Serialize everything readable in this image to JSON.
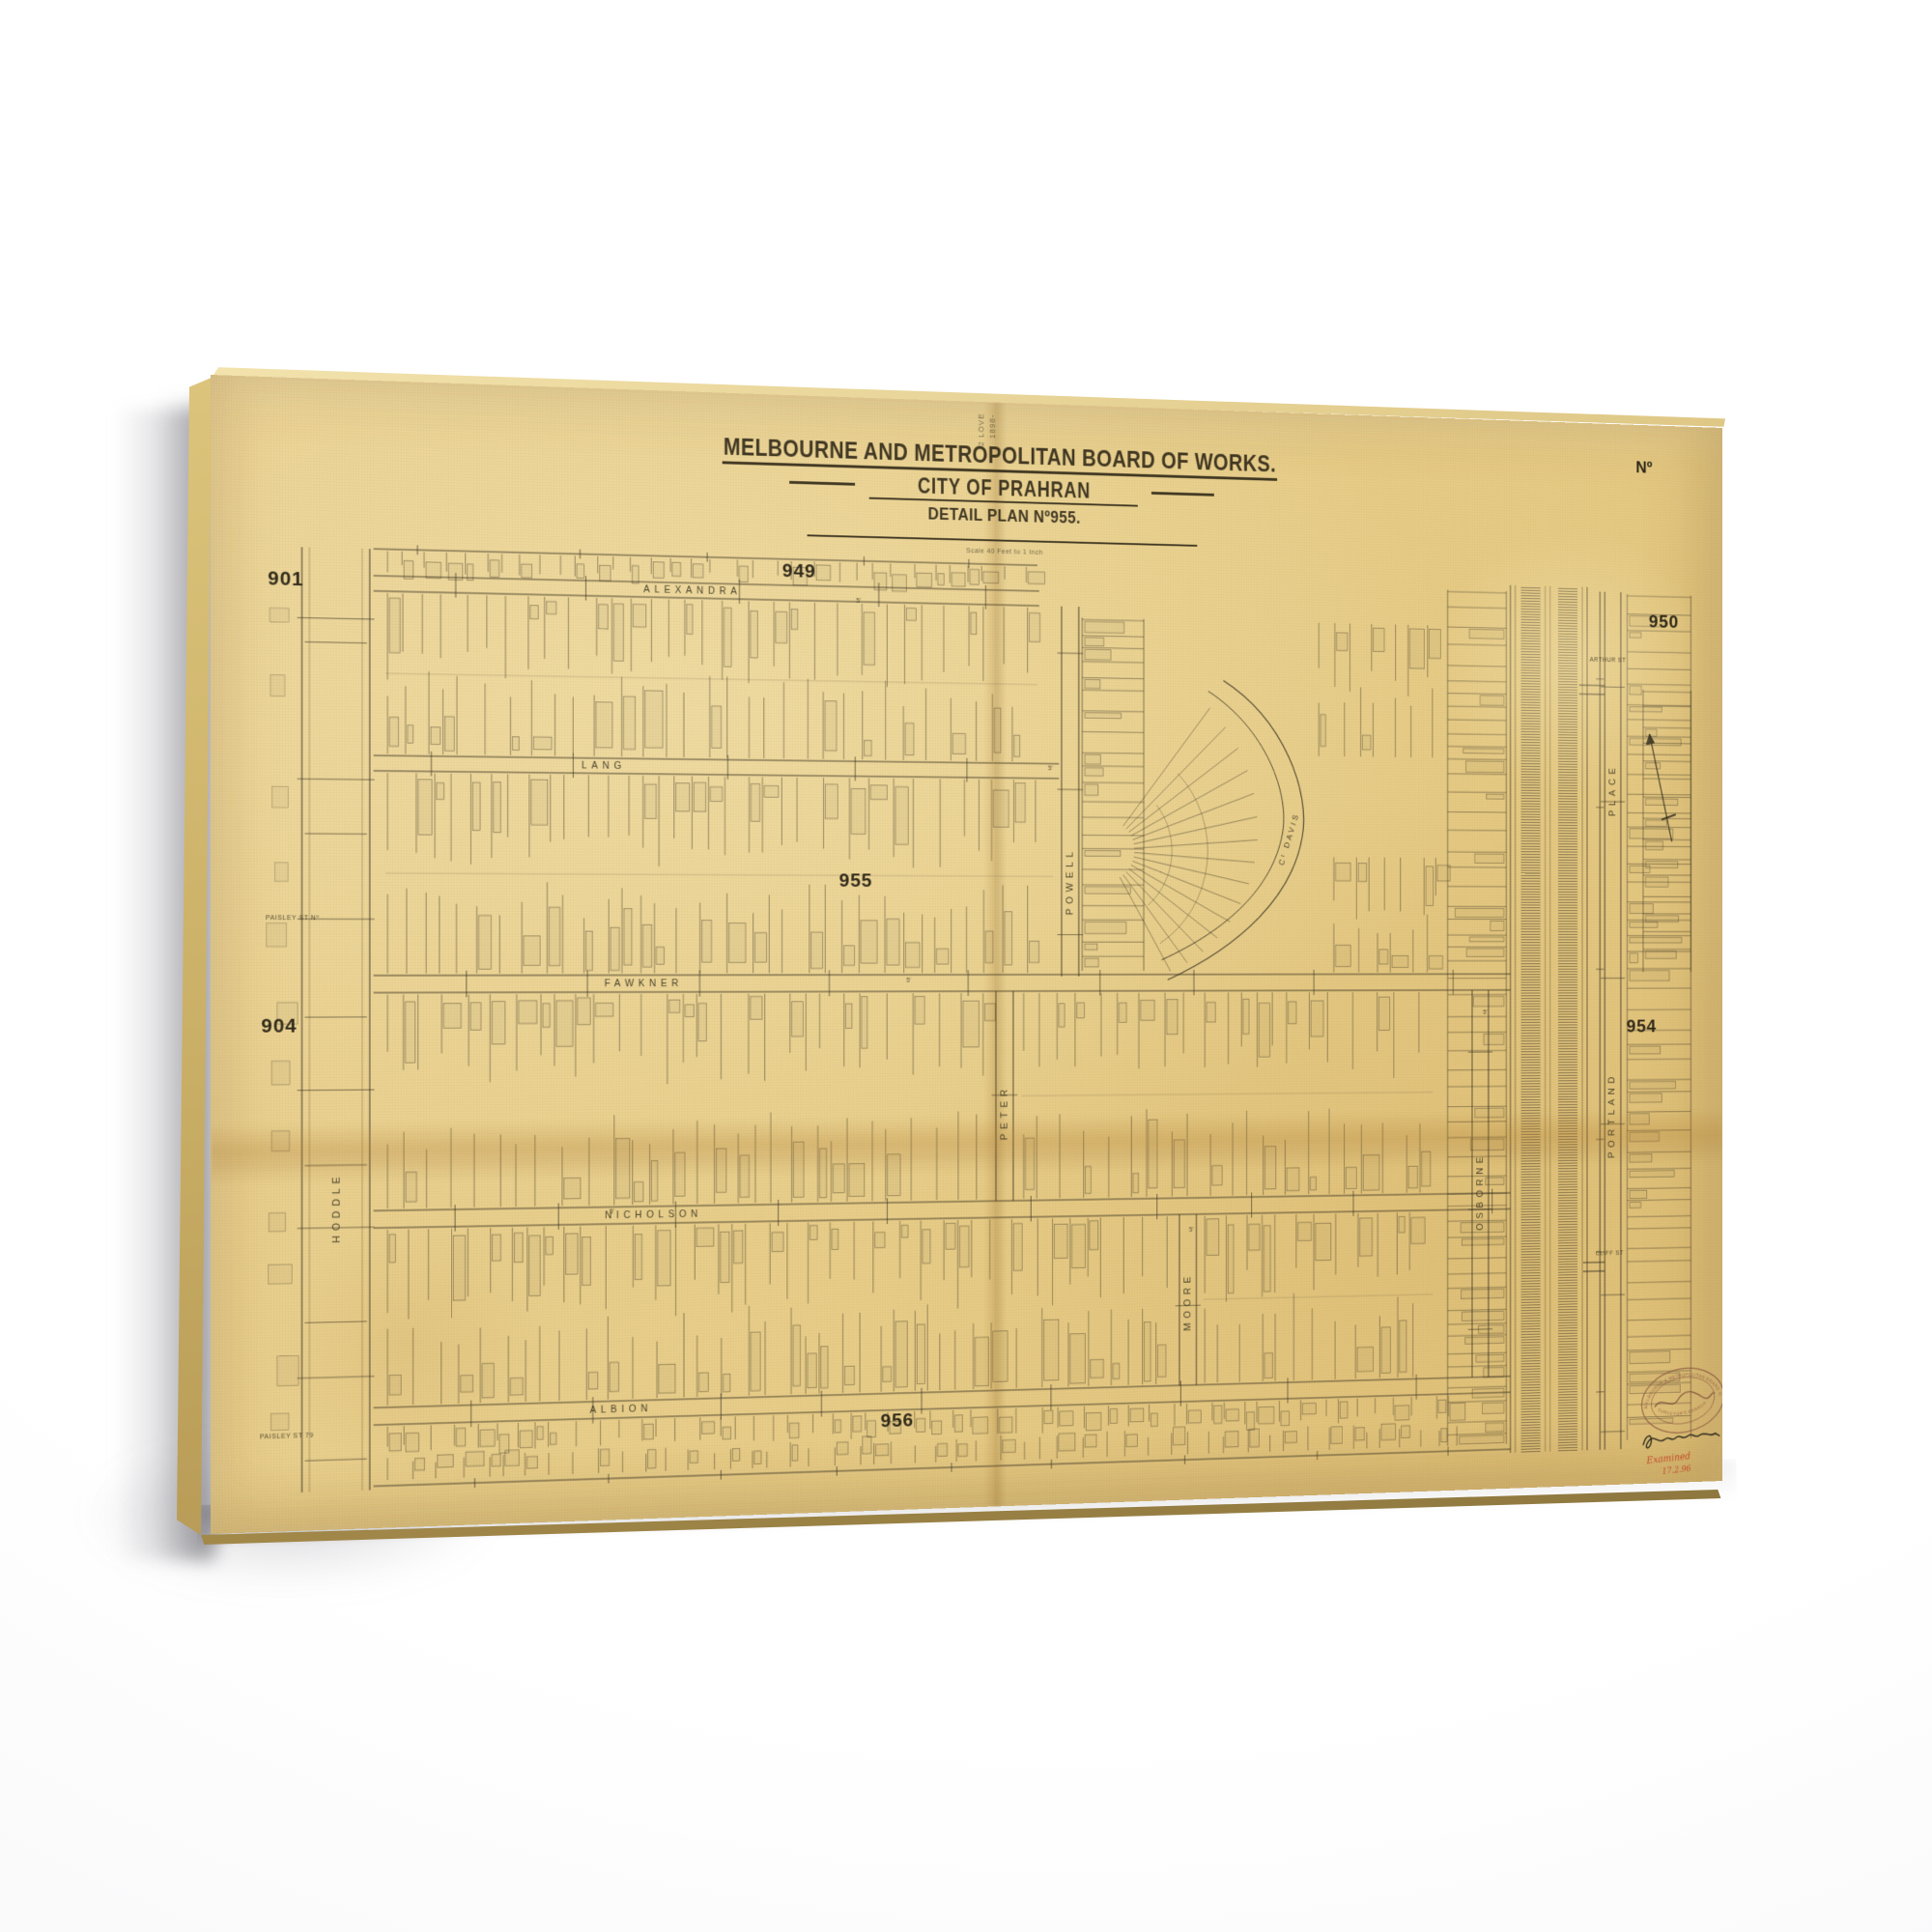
{
  "colors": {
    "wall": "#ffffff",
    "paper": "#e8ce8a",
    "ink": "#3a342a",
    "red_ink": "#c13a1f",
    "stamp_brown": "#8a5540"
  },
  "map": {
    "file_annotation": {
      "line1": "2 LOVE",
      "line2": "1898-"
    },
    "sheet_no_corner": "Nº",
    "title": {
      "line1": "MELBOURNE AND METROPOLITAN BOARD OF WORKS.",
      "line2": "CITY OF PRAHRAN",
      "line3": "DETAIL PLAN Nº955.",
      "scale_note": "Scale 40 Feet to 1 Inch"
    },
    "plan_numbers": {
      "nw": "901",
      "n": "949",
      "ne": "950",
      "w": "904",
      "e": "954",
      "center": "955",
      "s": "956"
    },
    "streets": {
      "alexandra": "ALEXANDRA",
      "lang": "LANG",
      "fawkner": "FAWKNER",
      "nicholson": "NICHOLSON",
      "albion": "ALBION",
      "hoddle": "HODDLE",
      "powell": "POWELL",
      "peter": "PETER",
      "moore": "MOORE",
      "osborne": "OSBORNE",
      "place": "PLACE",
      "portland": "PORTLAND",
      "davis": "Cᵗ DAVIS",
      "arthur": "ARTHUR ST",
      "cliff": "CLIFF ST",
      "paisley_upper": "PAISLEY ST Nº",
      "paisley_lower": "PAISLEY ST 79"
    },
    "lane_mark": "5'",
    "stamp": {
      "arc_top": "MELBOURNE & METROPOLITAN BOARD OF WORKS",
      "arc_bottom": "SURVEYOR'S BRANCH"
    },
    "inscriptions": {
      "red_line1": "Examined",
      "red_line2": "17.2.96"
    }
  }
}
